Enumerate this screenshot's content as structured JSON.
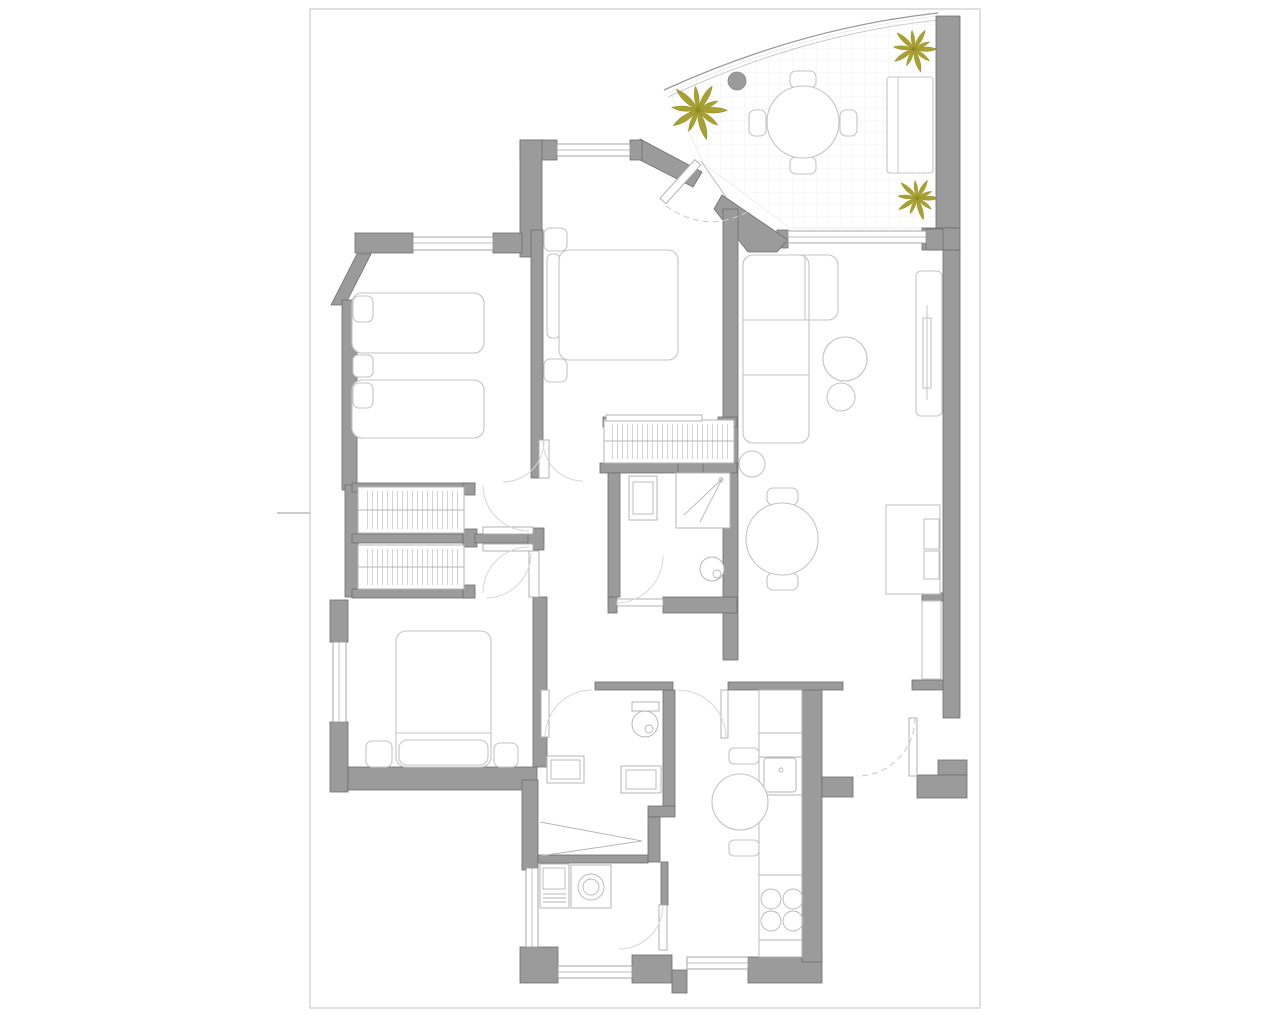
{
  "document": {
    "type": "architectural-floor-plan",
    "sheet_border_visible": true
  },
  "colors": {
    "background": "#ffffff",
    "sheet_border": "#cccccc",
    "wall_fill": "#9b9b9b",
    "wall_stroke": "#6e6e6e",
    "furniture_stroke": "#c4c4c4",
    "fixture_stroke": "#b6b6b6",
    "window_stroke": "#9b9b9b",
    "door_arc": "#d6d6d6",
    "dashed_door": "#c9c9c9",
    "tile_line": "#ececec",
    "hatch_stroke": "#bfbfbf",
    "plant_fill": "#a8a131",
    "plant_stroke": "#8f8a22",
    "column_fill": "#9b9b9b"
  },
  "plan": {
    "areas": [
      "terrace",
      "entry",
      "bedroom-1",
      "bedroom-2",
      "bedroom-3",
      "bathroom-1",
      "bathroom-2",
      "hallway",
      "living-dining-room",
      "kitchen",
      "utility-room",
      "entrance-vestibule"
    ],
    "symbols": {
      "plant_icons": 3,
      "twin_beds": 2,
      "double_beds": 2,
      "wardrobes": 3,
      "round_tables": 3,
      "corner_sofa": 1,
      "terrace_bench": 1,
      "tv_units": 2,
      "toilets": 2,
      "showers": 2,
      "sinks": 4,
      "washing_machine": 1,
      "hob_burners": 4,
      "windows": 7,
      "door_swings": 12,
      "column": 1
    }
  }
}
